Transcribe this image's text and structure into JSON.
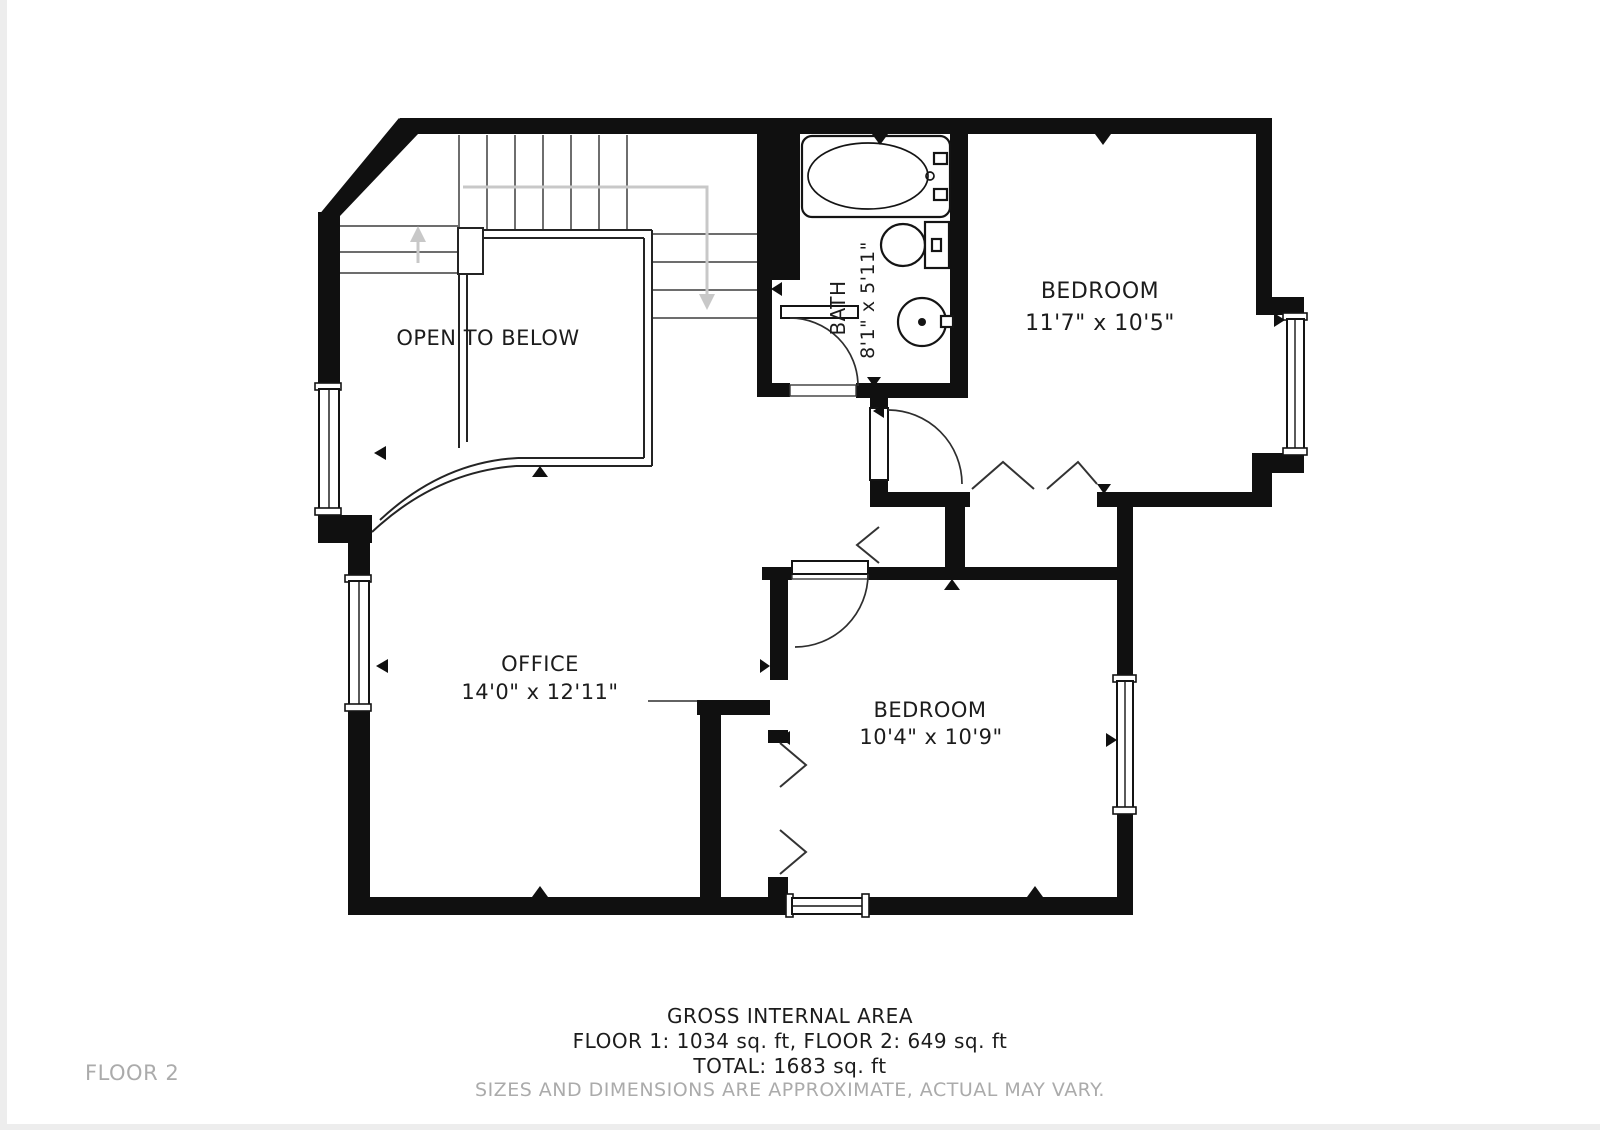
{
  "plan": {
    "floor_label": "FLOOR 2",
    "rooms": [
      {
        "id": "open_to_below",
        "name": "OPEN TO BELOW",
        "dims": ""
      },
      {
        "id": "bath",
        "name": "BATH",
        "dims": "8'1\" x 5'11\""
      },
      {
        "id": "bedroom_top",
        "name": "BEDROOM",
        "dims": "11'7\" x 10'5\""
      },
      {
        "id": "office",
        "name": "OFFICE",
        "dims": "14'0\" x 12'11\""
      },
      {
        "id": "bedroom_bottom",
        "name": "BEDROOM",
        "dims": "10'4\" x 10'9\""
      }
    ],
    "fixtures": [
      "bathtub",
      "toilet",
      "sink"
    ],
    "stair_arrows": [
      "up",
      "down"
    ],
    "footer": {
      "title": "GROSS INTERNAL AREA",
      "floors": "FLOOR 1: 1034 sq. ft, FLOOR 2: 649 sq. ft",
      "total": "TOTAL: 1683 sq. ft",
      "disclaimer": "SIZES AND DIMENSIONS ARE APPROXIMATE, ACTUAL MAY VARY."
    },
    "colors": {
      "wall": "#101010",
      "text": "#1c1c1c",
      "muted_text": "#ababab",
      "stair_arrow": "#c8c8c8",
      "background": "#ffffff"
    }
  }
}
